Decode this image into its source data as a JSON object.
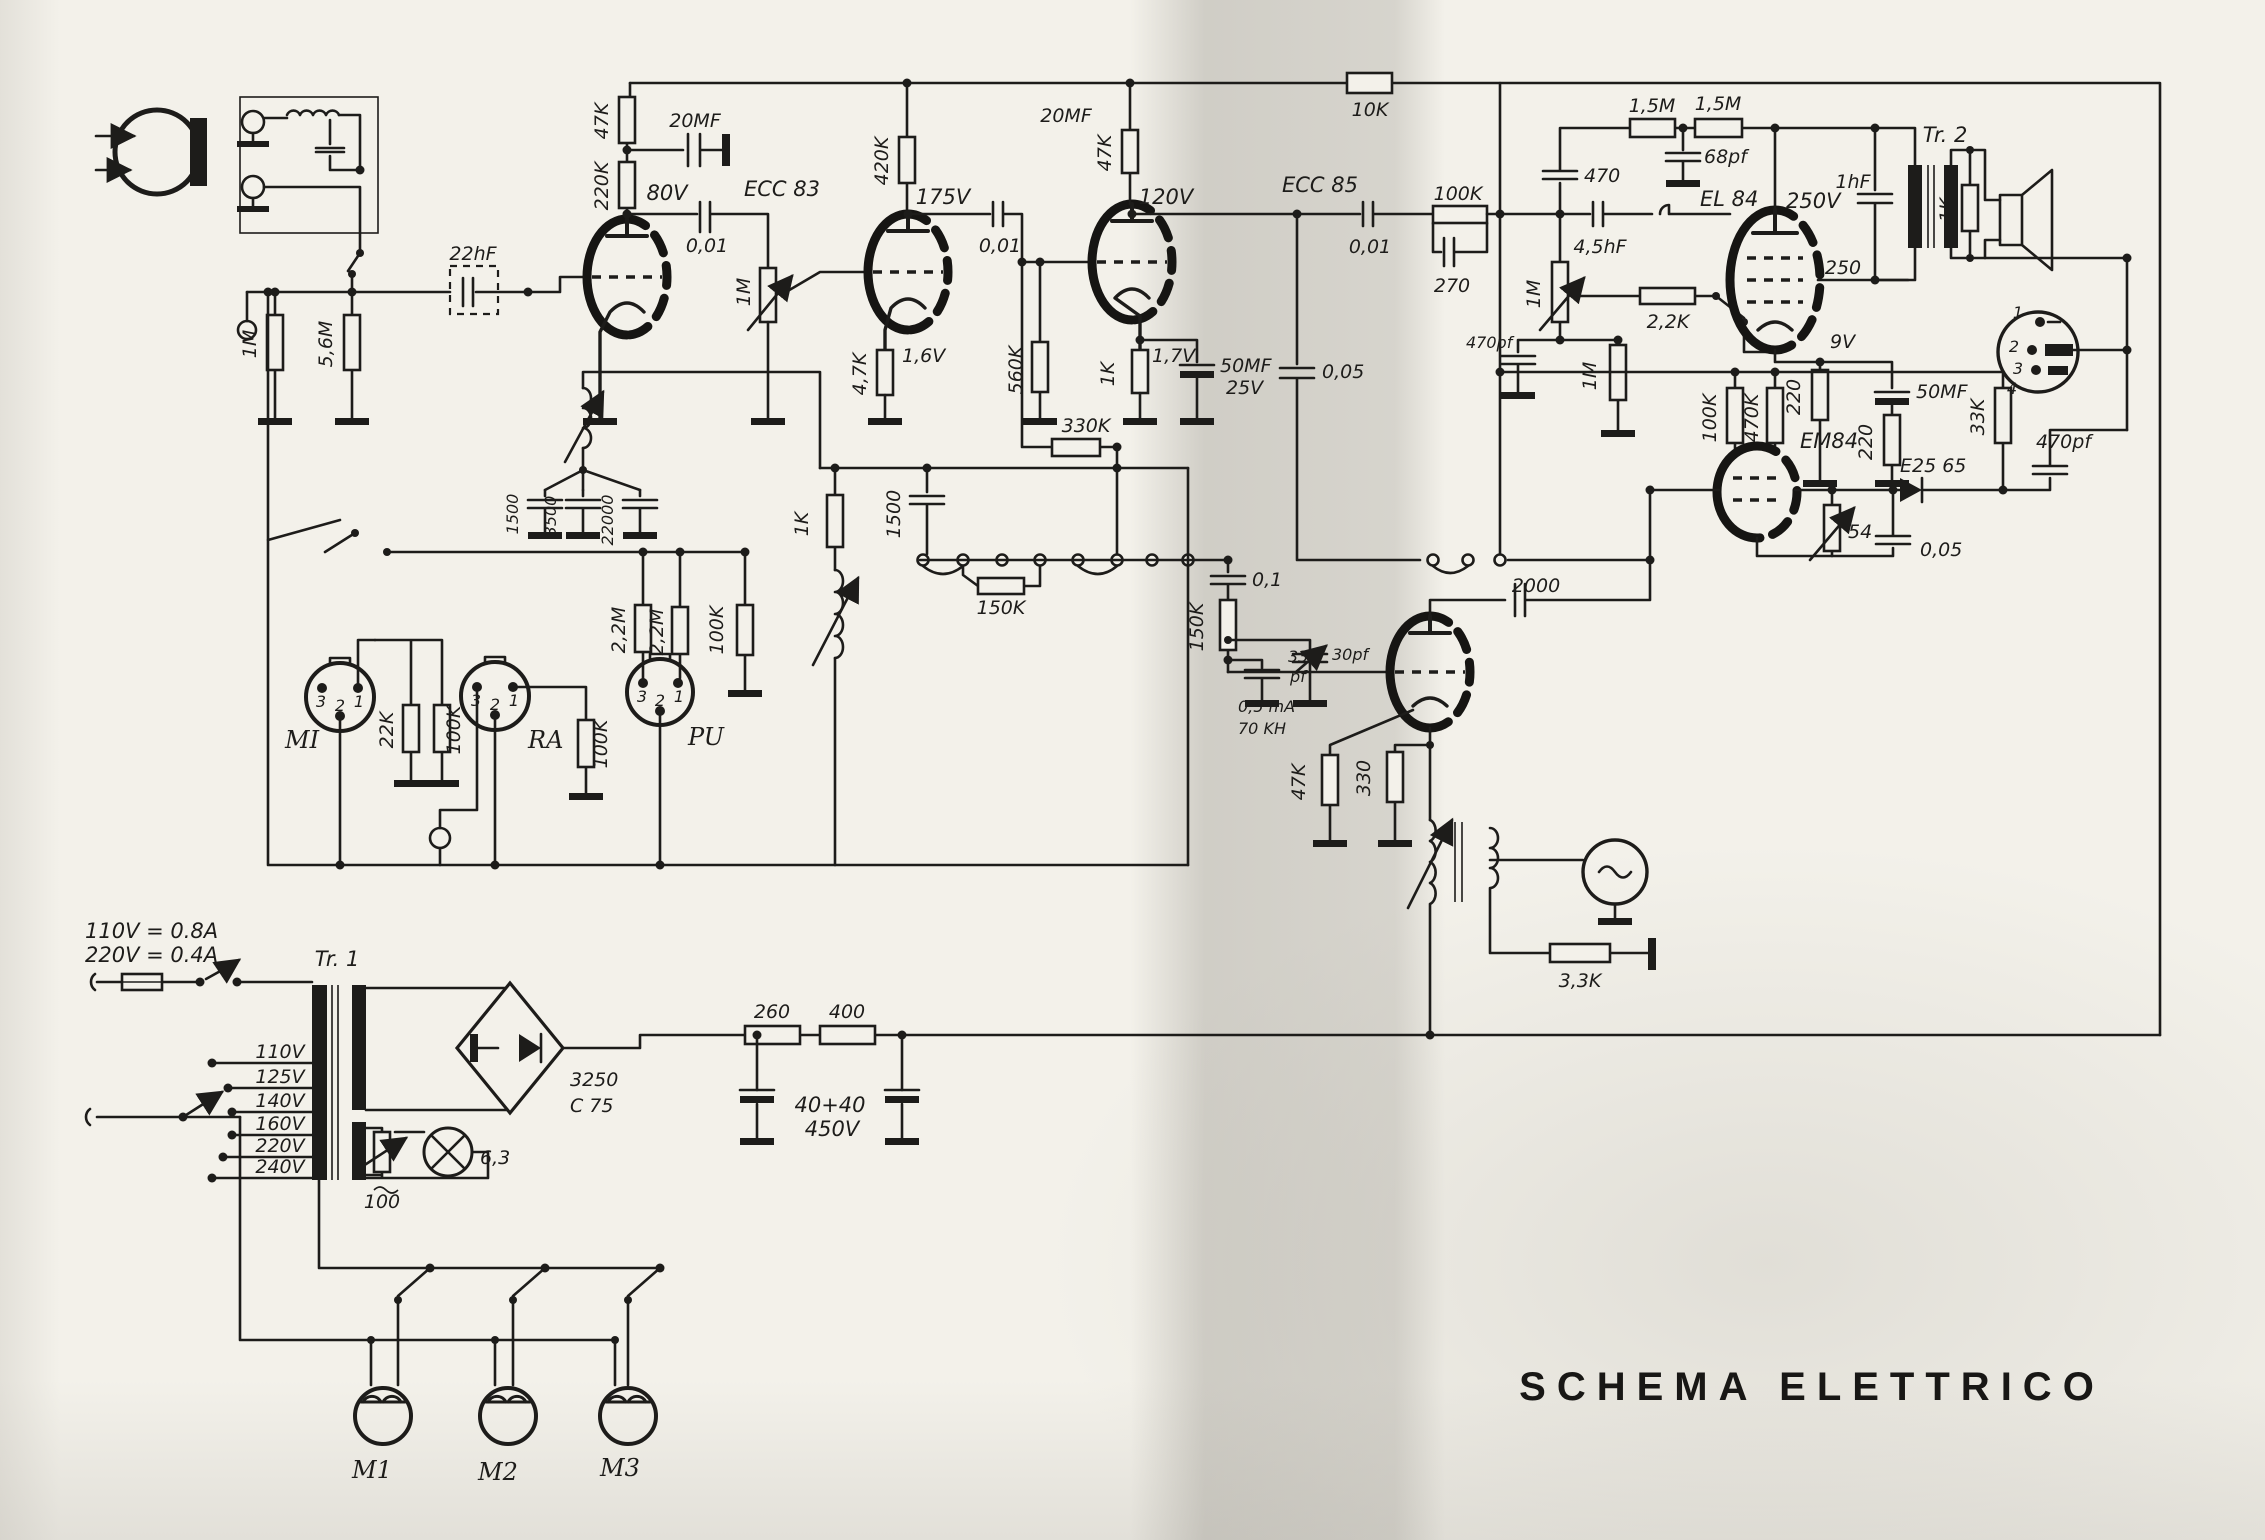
{
  "doc": {
    "title": "SCHEMA ELETTRICO"
  },
  "ratings": {
    "line1": "110V =  0.8A",
    "line2": "220V =  0.4A"
  },
  "transformers": {
    "tr1": "Tr. 1",
    "tr2": "Tr. 2"
  },
  "tubes": {
    "ecc83": "ECC 83",
    "ecc85": "ECC 85",
    "el84": "EL 84",
    "em84": "EM84"
  },
  "power": {
    "taps": [
      "110V",
      "125V",
      "140V",
      "160V",
      "220V",
      "240V"
    ],
    "rectifier1": "3250",
    "rectifier2": "C 75",
    "lamp": "6,3",
    "r_lamp": "100",
    "r260": "260",
    "r400": "400",
    "c_filter": "40+40",
    "v_filter": "450V",
    "motors": [
      "M1",
      "M2",
      "M3"
    ]
  },
  "sockets": {
    "mi": {
      "label": "MI",
      "pins": [
        "3",
        "2",
        "1"
      ]
    },
    "ra": {
      "label": "RA",
      "pins": [
        "3",
        "2",
        "1"
      ]
    },
    "pu": {
      "label": "PU",
      "pins": [
        "3",
        "2",
        "1"
      ]
    },
    "output_pins": [
      "1",
      "2",
      "3",
      "4"
    ]
  },
  "L": {
    "c22hf": "22hF",
    "r1m_in": "1M",
    "r56m": "5,6M",
    "r47k1": "47K",
    "r220k": "220K",
    "c20mf1": "20MF",
    "v80": "80V",
    "c001a": "0,01",
    "pot1m_a": "1M",
    "r420k": "420K",
    "v175": "175V",
    "c001b": "0,01",
    "c20mf2": "20MF",
    "r47k2": "47K",
    "v120": "120V",
    "r47k_cath": "4,7K",
    "v16": "1,6V",
    "r560k": "560K",
    "r1k_cath": "1K",
    "v17": "1,7V",
    "c50mf": "50MF",
    "v25": "25V",
    "c005a": "0,05",
    "r10k": "10K",
    "c001c": "0,01",
    "r100k_cpl": "100K",
    "r270": "270",
    "r330k": "330K",
    "c1500b": "1500",
    "r150k_sw": "150K",
    "r1k_osc": "1K",
    "c1500a": "1500",
    "c3500": "3500",
    "c22000": "22000",
    "r22k": "22K",
    "r100k_a": "100K",
    "r100k_b": "100K",
    "r22m_a": "2,2M",
    "r22m_b": "2,2M",
    "r100k_c": "100K",
    "c01": "0,1",
    "r150k_v": "150K",
    "c33": "33",
    "c33u": "pf",
    "c30pf": "30pf",
    "i05ma": "0,5 mA",
    "f70kh": "70 KH",
    "c2000": "2000",
    "r47k_osc": "47K",
    "r330": "330",
    "r33k_b": "3,3K",
    "c470": "470",
    "r15m_a": "1,5M",
    "r15m_b": "1,5M",
    "c68pf": "68pf",
    "c45hf": "4,5hF",
    "pot1m_b": "1M",
    "r22k2": "2,2K",
    "r1m_b": "1M",
    "c470pf_a": "470pf",
    "v250": "250V",
    "s250": "250",
    "v9": "9V",
    "r220a": "220",
    "r220b": "220",
    "c50mf2": "50MF",
    "c1hf": "1hF",
    "r1k_sp": "1K",
    "r100k_em": "100K",
    "r470k": "470K",
    "r33k": "33K",
    "c470pf_b": "470pf",
    "d_e25": "E25 65",
    "p54": "54",
    "c005b": "0,05"
  }
}
